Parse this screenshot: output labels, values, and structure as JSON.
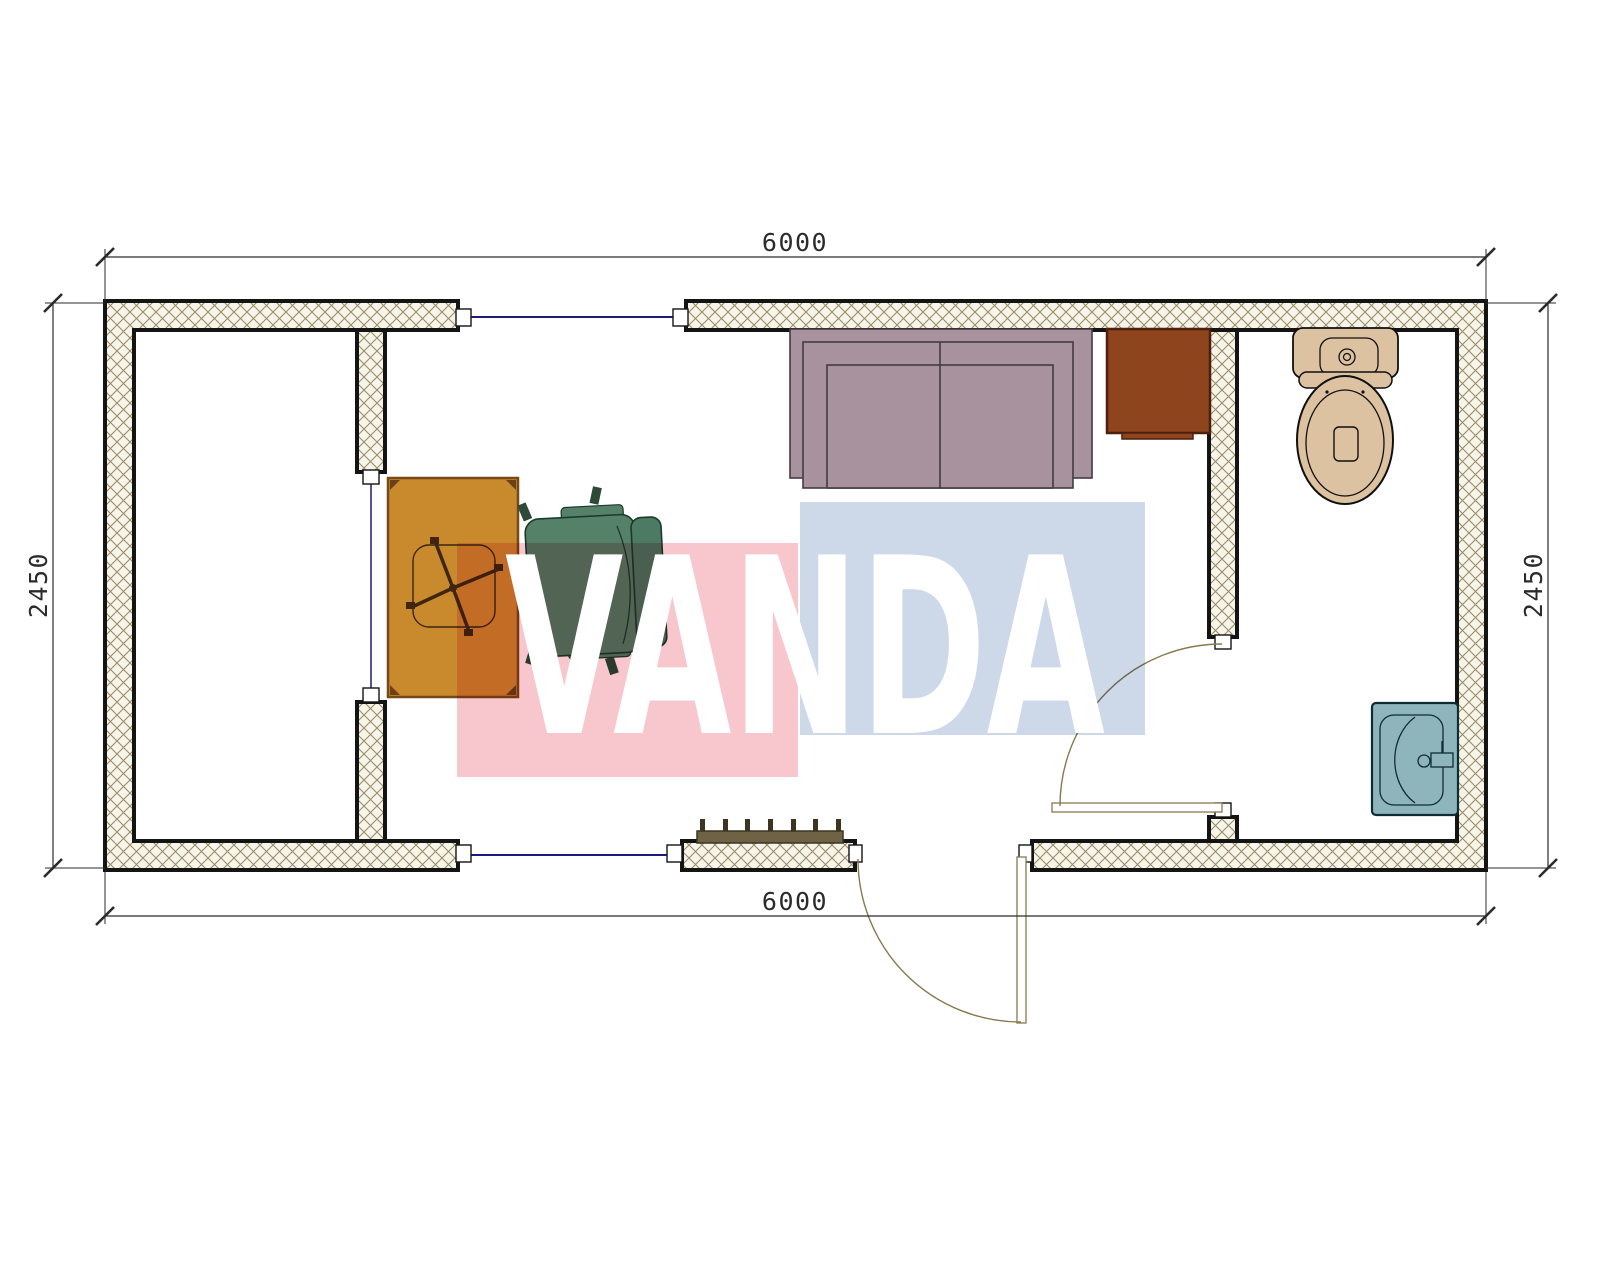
{
  "dimensions": {
    "top": {
      "label": "6000"
    },
    "bottom": {
      "label": "6000"
    },
    "left": {
      "label": "2450"
    },
    "right": {
      "label": "2450"
    }
  },
  "watermark": {
    "text": "VANDA",
    "pink": "#f8c7cd",
    "blue": "#cdd9e9",
    "text_color": "#ffffff"
  },
  "colors": {
    "wall_fill": "#f7f4ea",
    "wall_hatch_line": "#9a8d68",
    "wall_outline": "#141414",
    "glazing_line": "#1c1c78",
    "door_line": "#8a7850",
    "desk": "#c98a2e",
    "desk_border": "#774917",
    "chair_seat": "#548168",
    "chair_back": "#4c7a63",
    "sofa": "#a8929e",
    "side_table": "#8e441d",
    "radiator": "#6f6345",
    "toilet": "#ddc2a1",
    "sink": "#8fb5bc",
    "dim_color": "#2b2b2b"
  }
}
